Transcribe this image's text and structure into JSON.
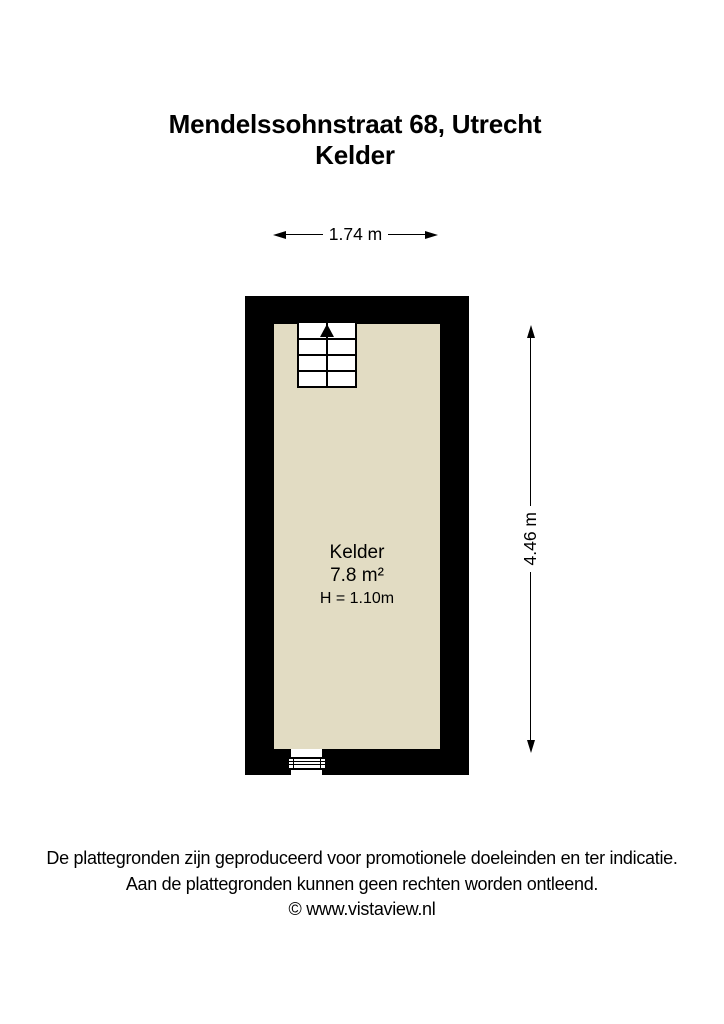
{
  "title": {
    "address": "Mendelssohnstraat 68, Utrecht",
    "floor": "Kelder"
  },
  "dimensions": {
    "width": "1.74 m",
    "height": "4.46 m"
  },
  "room": {
    "name": "Kelder",
    "area": "7.8 m²",
    "ceiling_height": "H = 1.10m"
  },
  "footer": {
    "line1": "De plattegronden zijn geproduceerd voor promotionele doeleinden en ter indicatie.",
    "line2": "Aan de plattegronden kunnen geen rechten worden ontleend.",
    "line3": "© www.vistaview.nl"
  },
  "colors": {
    "wall": "#000000",
    "floor": "#e2dcc3",
    "background": "#ffffff",
    "textcolor": "#000000"
  }
}
